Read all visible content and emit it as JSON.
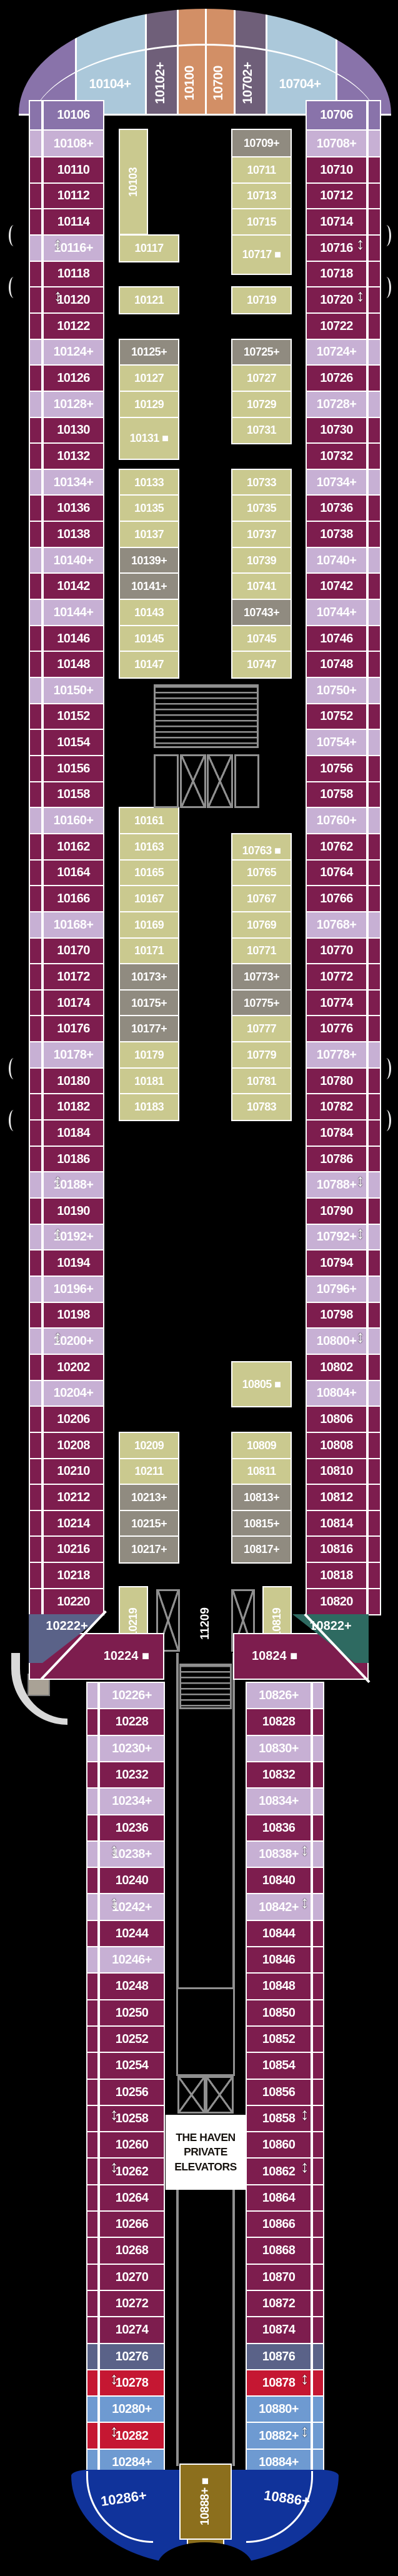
{
  "palette": {
    "burgundy": "#7d1d4e",
    "lavender": "#c7b0d4",
    "purple": "#8973aa",
    "lightblue": "#abc8da",
    "mauve": "#6f5f79",
    "orange": "#d28f66",
    "olive": "#cac98f",
    "gray": "#908b80",
    "slate": "#5a6288",
    "teal": "#2e6a61",
    "red": "#c51732",
    "steel": "#6e9ad1",
    "navy": "#10339b",
    "gold": "#8c6f1d",
    "wall": "#8f8f8f",
    "white": "#ffffff"
  },
  "bow": {
    "bands": [
      {
        "n": "",
        "c": "purple"
      },
      {
        "n": "10104+",
        "c": "lightblue",
        "vert": false
      },
      {
        "n": "10102+",
        "c": "mauve",
        "vert": true
      },
      {
        "n": "10100",
        "c": "orange",
        "vert": true
      },
      {
        "n": "10700",
        "c": "orange",
        "vert": true
      },
      {
        "n": "10702+",
        "c": "mauve",
        "vert": true
      },
      {
        "n": "10704+",
        "c": "lightblue",
        "vert": false
      },
      {
        "n": "",
        "c": "purple"
      }
    ],
    "port_rows": [
      {
        "n": "10106",
        "c": "purple"
      },
      {
        "n": "10108+",
        "c": "lavender"
      }
    ],
    "stbd_rows": [
      {
        "n": "10706",
        "c": "purple"
      },
      {
        "n": "10708+",
        "c": "lavender"
      }
    ]
  },
  "wide": {
    "port_outer": [
      {
        "n": "10110",
        "c": "burgundy"
      },
      {
        "n": "10112",
        "c": "burgundy"
      },
      {
        "n": "10114",
        "c": "burgundy"
      },
      {
        "n": "10116+",
        "c": "lavender"
      },
      {
        "n": "10118",
        "c": "burgundy"
      },
      {
        "n": "10120",
        "c": "burgundy"
      },
      {
        "n": "10122",
        "c": "burgundy"
      },
      {
        "n": "10124+",
        "c": "lavender"
      },
      {
        "n": "10126",
        "c": "burgundy"
      },
      {
        "n": "10128+",
        "c": "lavender"
      },
      {
        "n": "10130",
        "c": "burgundy"
      },
      {
        "n": "10132",
        "c": "burgundy"
      },
      {
        "n": "10134+",
        "c": "lavender"
      },
      {
        "n": "10136",
        "c": "burgundy"
      },
      {
        "n": "10138",
        "c": "burgundy"
      },
      {
        "n": "10140+",
        "c": "lavender"
      },
      {
        "n": "10142",
        "c": "burgundy"
      },
      {
        "n": "10144+",
        "c": "lavender"
      },
      {
        "n": "10146",
        "c": "burgundy"
      },
      {
        "n": "10148",
        "c": "burgundy"
      },
      {
        "n": "10150+",
        "c": "lavender"
      },
      {
        "n": "10152",
        "c": "burgundy"
      },
      {
        "n": "10154",
        "c": "burgundy"
      },
      {
        "n": "10156",
        "c": "burgundy"
      },
      {
        "n": "10158",
        "c": "burgundy"
      },
      {
        "n": "10160+",
        "c": "lavender"
      },
      {
        "n": "10162",
        "c": "burgundy"
      },
      {
        "n": "10164",
        "c": "burgundy"
      },
      {
        "n": "10166",
        "c": "burgundy"
      },
      {
        "n": "10168+",
        "c": "lavender"
      },
      {
        "n": "10170",
        "c": "burgundy"
      },
      {
        "n": "10172",
        "c": "burgundy"
      },
      {
        "n": "10174",
        "c": "burgundy"
      },
      {
        "n": "10176",
        "c": "burgundy"
      },
      {
        "n": "10178+",
        "c": "lavender"
      },
      {
        "n": "10180",
        "c": "burgundy"
      },
      {
        "n": "10182",
        "c": "burgundy"
      },
      {
        "n": "10184",
        "c": "burgundy"
      },
      {
        "n": "10186",
        "c": "burgundy"
      },
      {
        "n": "10188+",
        "c": "lavender"
      },
      {
        "n": "10190",
        "c": "burgundy"
      },
      {
        "n": "10192+",
        "c": "lavender"
      },
      {
        "n": "10194",
        "c": "burgundy"
      },
      {
        "n": "10196+",
        "c": "lavender"
      },
      {
        "n": "10198",
        "c": "burgundy"
      },
      {
        "n": "10200+",
        "c": "lavender"
      },
      {
        "n": "10202",
        "c": "burgundy"
      },
      {
        "n": "10204+",
        "c": "lavender"
      },
      {
        "n": "10206",
        "c": "burgundy"
      },
      {
        "n": "10208",
        "c": "burgundy"
      },
      {
        "n": "10210",
        "c": "burgundy"
      },
      {
        "n": "10212",
        "c": "burgundy"
      },
      {
        "n": "10214",
        "c": "burgundy"
      },
      {
        "n": "10216",
        "c": "burgundy"
      },
      {
        "n": "10218",
        "c": "burgundy"
      },
      {
        "n": "10220",
        "c": "burgundy"
      }
    ],
    "stbd_outer": [
      {
        "n": "10710",
        "c": "burgundy"
      },
      {
        "n": "10712",
        "c": "burgundy"
      },
      {
        "n": "10714",
        "c": "burgundy"
      },
      {
        "n": "10716",
        "c": "burgundy"
      },
      {
        "n": "10718",
        "c": "burgundy"
      },
      {
        "n": "10720",
        "c": "burgundy"
      },
      {
        "n": "10722",
        "c": "burgundy"
      },
      {
        "n": "10724+",
        "c": "lavender"
      },
      {
        "n": "10726",
        "c": "burgundy"
      },
      {
        "n": "10728+",
        "c": "lavender"
      },
      {
        "n": "10730",
        "c": "burgundy"
      },
      {
        "n": "10732",
        "c": "burgundy"
      },
      {
        "n": "10734+",
        "c": "lavender"
      },
      {
        "n": "10736",
        "c": "burgundy"
      },
      {
        "n": "10738",
        "c": "burgundy"
      },
      {
        "n": "10740+",
        "c": "lavender"
      },
      {
        "n": "10742",
        "c": "burgundy"
      },
      {
        "n": "10744+",
        "c": "lavender"
      },
      {
        "n": "10746",
        "c": "burgundy"
      },
      {
        "n": "10748",
        "c": "burgundy"
      },
      {
        "n": "10750+",
        "c": "lavender"
      },
      {
        "n": "10752",
        "c": "burgundy"
      },
      {
        "n": "10754+",
        "c": "lavender"
      },
      {
        "n": "10756",
        "c": "burgundy"
      },
      {
        "n": "10758",
        "c": "burgundy"
      },
      {
        "n": "10760+",
        "c": "lavender"
      },
      {
        "n": "10762",
        "c": "burgundy"
      },
      {
        "n": "10764",
        "c": "burgundy"
      },
      {
        "n": "10766",
        "c": "burgundy"
      },
      {
        "n": "10768+",
        "c": "lavender"
      },
      {
        "n": "10770",
        "c": "burgundy"
      },
      {
        "n": "10772",
        "c": "burgundy"
      },
      {
        "n": "10774",
        "c": "burgundy"
      },
      {
        "n": "10776",
        "c": "burgundy"
      },
      {
        "n": "10778+",
        "c": "lavender"
      },
      {
        "n": "10780",
        "c": "burgundy"
      },
      {
        "n": "10782",
        "c": "burgundy"
      },
      {
        "n": "10784",
        "c": "burgundy"
      },
      {
        "n": "10786",
        "c": "burgundy"
      },
      {
        "n": "10788+",
        "c": "lavender"
      },
      {
        "n": "10790",
        "c": "burgundy"
      },
      {
        "n": "10792+",
        "c": "lavender"
      },
      {
        "n": "10794",
        "c": "burgundy"
      },
      {
        "n": "10796+",
        "c": "lavender"
      },
      {
        "n": "10798",
        "c": "burgundy"
      },
      {
        "n": "10800+",
        "c": "lavender"
      },
      {
        "n": "10802",
        "c": "burgundy"
      },
      {
        "n": "10804+",
        "c": "lavender"
      },
      {
        "n": "10806",
        "c": "burgundy"
      },
      {
        "n": "10808",
        "c": "burgundy"
      },
      {
        "n": "10810",
        "c": "burgundy"
      },
      {
        "n": "10812",
        "c": "burgundy"
      },
      {
        "n": "10814",
        "c": "burgundy"
      },
      {
        "n": "10816",
        "c": "burgundy"
      },
      {
        "n": "10818",
        "c": "burgundy"
      },
      {
        "n": "10820",
        "c": "burgundy"
      }
    ],
    "port_inner": [
      {
        "n": "10103",
        "c": "olive",
        "i": -1.05,
        "span": 4.0,
        "vert": true,
        "w": 47
      },
      {
        "n": "10117",
        "c": "olive",
        "i": 3
      },
      {
        "n": "10121",
        "c": "olive",
        "i": 5
      },
      {
        "n": "10125+",
        "c": "gray",
        "i": 7
      },
      {
        "n": "10127",
        "c": "olive",
        "i": 8
      },
      {
        "n": "10129",
        "c": "olive",
        "i": 9
      },
      {
        "n": "10131 ■",
        "c": "olive",
        "i": 10,
        "span": 1.6
      },
      {
        "n": "10133",
        "c": "olive",
        "i": 12
      },
      {
        "n": "10135",
        "c": "olive",
        "i": 13
      },
      {
        "n": "10137",
        "c": "olive",
        "i": 14
      },
      {
        "n": "10139+",
        "c": "gray",
        "i": 15
      },
      {
        "n": "10141+",
        "c": "gray",
        "i": 16
      },
      {
        "n": "10143",
        "c": "olive",
        "i": 17
      },
      {
        "n": "10145",
        "c": "olive",
        "i": 18
      },
      {
        "n": "10147",
        "c": "olive",
        "i": 19
      },
      {
        "n": "10161",
        "c": "olive",
        "i": 25
      },
      {
        "n": "10163",
        "c": "olive",
        "i": 26
      },
      {
        "n": "10165",
        "c": "olive",
        "i": 27
      },
      {
        "n": "10167",
        "c": "olive",
        "i": 28
      },
      {
        "n": "10169",
        "c": "olive",
        "i": 29
      },
      {
        "n": "10171",
        "c": "olive",
        "i": 30
      },
      {
        "n": "10173+",
        "c": "gray",
        "i": 31
      },
      {
        "n": "10175+",
        "c": "gray",
        "i": 32
      },
      {
        "n": "10177+",
        "c": "gray",
        "i": 33
      },
      {
        "n": "10179",
        "c": "olive",
        "i": 34
      },
      {
        "n": "10181",
        "c": "olive",
        "i": 35
      },
      {
        "n": "10183",
        "c": "olive",
        "i": 36
      },
      {
        "n": "10209",
        "c": "olive",
        "i": 49
      },
      {
        "n": "10211",
        "c": "olive",
        "i": 50
      },
      {
        "n": "10213+",
        "c": "gray",
        "i": 51
      },
      {
        "n": "10215+",
        "c": "gray",
        "i": 52
      },
      {
        "n": "10217+",
        "c": "gray",
        "i": 53
      }
    ],
    "stbd_inner": [
      {
        "n": "10709+",
        "c": "gray",
        "i": -1.05,
        "span": 1.05
      },
      {
        "n": "10711",
        "c": "olive",
        "i": 0
      },
      {
        "n": "10713",
        "c": "olive",
        "i": 1
      },
      {
        "n": "10715",
        "c": "olive",
        "i": 2
      },
      {
        "n": "10717 ■",
        "c": "olive",
        "i": 3,
        "span": 1.5
      },
      {
        "n": "10719",
        "c": "olive",
        "i": 5
      },
      {
        "n": "10725+",
        "c": "gray",
        "i": 7
      },
      {
        "n": "10727",
        "c": "olive",
        "i": 8
      },
      {
        "n": "10729",
        "c": "olive",
        "i": 9
      },
      {
        "n": "10731",
        "c": "olive",
        "i": 10
      },
      {
        "n": "10733",
        "c": "olive",
        "i": 12
      },
      {
        "n": "10735",
        "c": "olive",
        "i": 13
      },
      {
        "n": "10737",
        "c": "olive",
        "i": 14
      },
      {
        "n": "10739",
        "c": "olive",
        "i": 15
      },
      {
        "n": "10741",
        "c": "olive",
        "i": 16
      },
      {
        "n": "10743+",
        "c": "gray",
        "i": 17
      },
      {
        "n": "10745",
        "c": "olive",
        "i": 18
      },
      {
        "n": "10747",
        "c": "olive",
        "i": 19
      },
      {
        "n": "10763 ■",
        "c": "olive",
        "i": 26,
        "span": 1.3
      },
      {
        "n": "10765",
        "c": "olive",
        "i": 27
      },
      {
        "n": "10767",
        "c": "olive",
        "i": 28
      },
      {
        "n": "10769",
        "c": "olive",
        "i": 29
      },
      {
        "n": "10771",
        "c": "olive",
        "i": 30
      },
      {
        "n": "10773+",
        "c": "gray",
        "i": 31
      },
      {
        "n": "10775+",
        "c": "gray",
        "i": 32
      },
      {
        "n": "10777",
        "c": "olive",
        "i": 33
      },
      {
        "n": "10779",
        "c": "olive",
        "i": 34
      },
      {
        "n": "10781",
        "c": "olive",
        "i": 35
      },
      {
        "n": "10783",
        "c": "olive",
        "i": 36
      },
      {
        "n": "10805 ■",
        "c": "olive",
        "i": 46.3,
        "span": 1.7
      },
      {
        "n": "10809",
        "c": "olive",
        "i": 49
      },
      {
        "n": "10811",
        "c": "olive",
        "i": 50
      },
      {
        "n": "10813+",
        "c": "gray",
        "i": 51
      },
      {
        "n": "10815+",
        "c": "gray",
        "i": 52
      },
      {
        "n": "10817+",
        "c": "gray",
        "i": 53
      }
    ],
    "connecting_port": [
      3,
      5,
      39,
      41,
      45
    ],
    "connecting_stbd": [
      3,
      5,
      39,
      41,
      45
    ],
    "davit_rows": [
      3,
      5,
      35,
      37
    ]
  },
  "mid": {
    "elevator_label": "11209",
    "stair_cabin_port": "10219",
    "stair_cabin_stbd": "10819"
  },
  "transition": {
    "port_suite": "10222+",
    "port_cabin": "10224 ■",
    "stbd_suite": "10822+",
    "stbd_cabin": "10824 ■"
  },
  "narrow": {
    "port": [
      {
        "n": "10226+",
        "c": "lavender"
      },
      {
        "n": "10228",
        "c": "burgundy"
      },
      {
        "n": "10230+",
        "c": "lavender"
      },
      {
        "n": "10232",
        "c": "burgundy"
      },
      {
        "n": "10234+",
        "c": "lavender"
      },
      {
        "n": "10236",
        "c": "burgundy"
      },
      {
        "n": "10238+",
        "c": "lavender"
      },
      {
        "n": "10240",
        "c": "burgundy"
      },
      {
        "n": "10242+",
        "c": "lavender"
      },
      {
        "n": "10244",
        "c": "burgundy"
      },
      {
        "n": "10246+",
        "c": "lavender"
      },
      {
        "n": "10248",
        "c": "burgundy"
      },
      {
        "n": "10250",
        "c": "burgundy"
      },
      {
        "n": "10252",
        "c": "burgundy"
      },
      {
        "n": "10254",
        "c": "burgundy"
      },
      {
        "n": "10256",
        "c": "burgundy"
      },
      {
        "n": "10258",
        "c": "burgundy"
      },
      {
        "n": "10260",
        "c": "burgundy"
      },
      {
        "n": "10262",
        "c": "burgundy"
      },
      {
        "n": "10264",
        "c": "burgundy"
      },
      {
        "n": "10266",
        "c": "burgundy"
      },
      {
        "n": "10268",
        "c": "burgundy"
      },
      {
        "n": "10270",
        "c": "burgundy"
      },
      {
        "n": "10272",
        "c": "burgundy"
      },
      {
        "n": "10274",
        "c": "burgundy"
      },
      {
        "n": "10276",
        "c": "slate"
      },
      {
        "n": "10278",
        "c": "red"
      },
      {
        "n": "10280+",
        "c": "steel"
      },
      {
        "n": "10282",
        "c": "red"
      },
      {
        "n": "10284+",
        "c": "steel"
      }
    ],
    "stbd": [
      {
        "n": "10826+",
        "c": "lavender"
      },
      {
        "n": "10828",
        "c": "burgundy"
      },
      {
        "n": "10830+",
        "c": "lavender"
      },
      {
        "n": "10832",
        "c": "burgundy"
      },
      {
        "n": "10834+",
        "c": "lavender"
      },
      {
        "n": "10836",
        "c": "burgundy"
      },
      {
        "n": "10838+",
        "c": "lavender"
      },
      {
        "n": "10840",
        "c": "burgundy"
      },
      {
        "n": "10842+",
        "c": "lavender"
      },
      {
        "n": "10844",
        "c": "burgundy"
      },
      {
        "n": "10846",
        "c": "burgundy"
      },
      {
        "n": "10848",
        "c": "burgundy"
      },
      {
        "n": "10850",
        "c": "burgundy"
      },
      {
        "n": "10852",
        "c": "burgundy"
      },
      {
        "n": "10854",
        "c": "burgundy"
      },
      {
        "n": "10856",
        "c": "burgundy"
      },
      {
        "n": "10858",
        "c": "burgundy"
      },
      {
        "n": "10860",
        "c": "burgundy"
      },
      {
        "n": "10862",
        "c": "burgundy"
      },
      {
        "n": "10864",
        "c": "burgundy"
      },
      {
        "n": "10866",
        "c": "burgundy"
      },
      {
        "n": "10868",
        "c": "burgundy"
      },
      {
        "n": "10870",
        "c": "burgundy"
      },
      {
        "n": "10872",
        "c": "burgundy"
      },
      {
        "n": "10874",
        "c": "burgundy"
      },
      {
        "n": "10876",
        "c": "slate"
      },
      {
        "n": "10878",
        "c": "red"
      },
      {
        "n": "10880+",
        "c": "steel"
      },
      {
        "n": "10882+",
        "c": "steel"
      },
      {
        "n": "10884+",
        "c": "steel"
      }
    ],
    "connecting_port": [
      6,
      8,
      16,
      18,
      26,
      28
    ],
    "connecting_stbd": [
      6,
      8,
      16,
      18,
      26,
      28
    ],
    "haven": {
      "lines": [
        "THE HAVEN",
        "PRIVATE",
        "ELEVATORS"
      ]
    }
  },
  "stern": {
    "port_suite": "10286+",
    "stbd_suite": "10886+",
    "center_suite": "10888+ ■"
  }
}
